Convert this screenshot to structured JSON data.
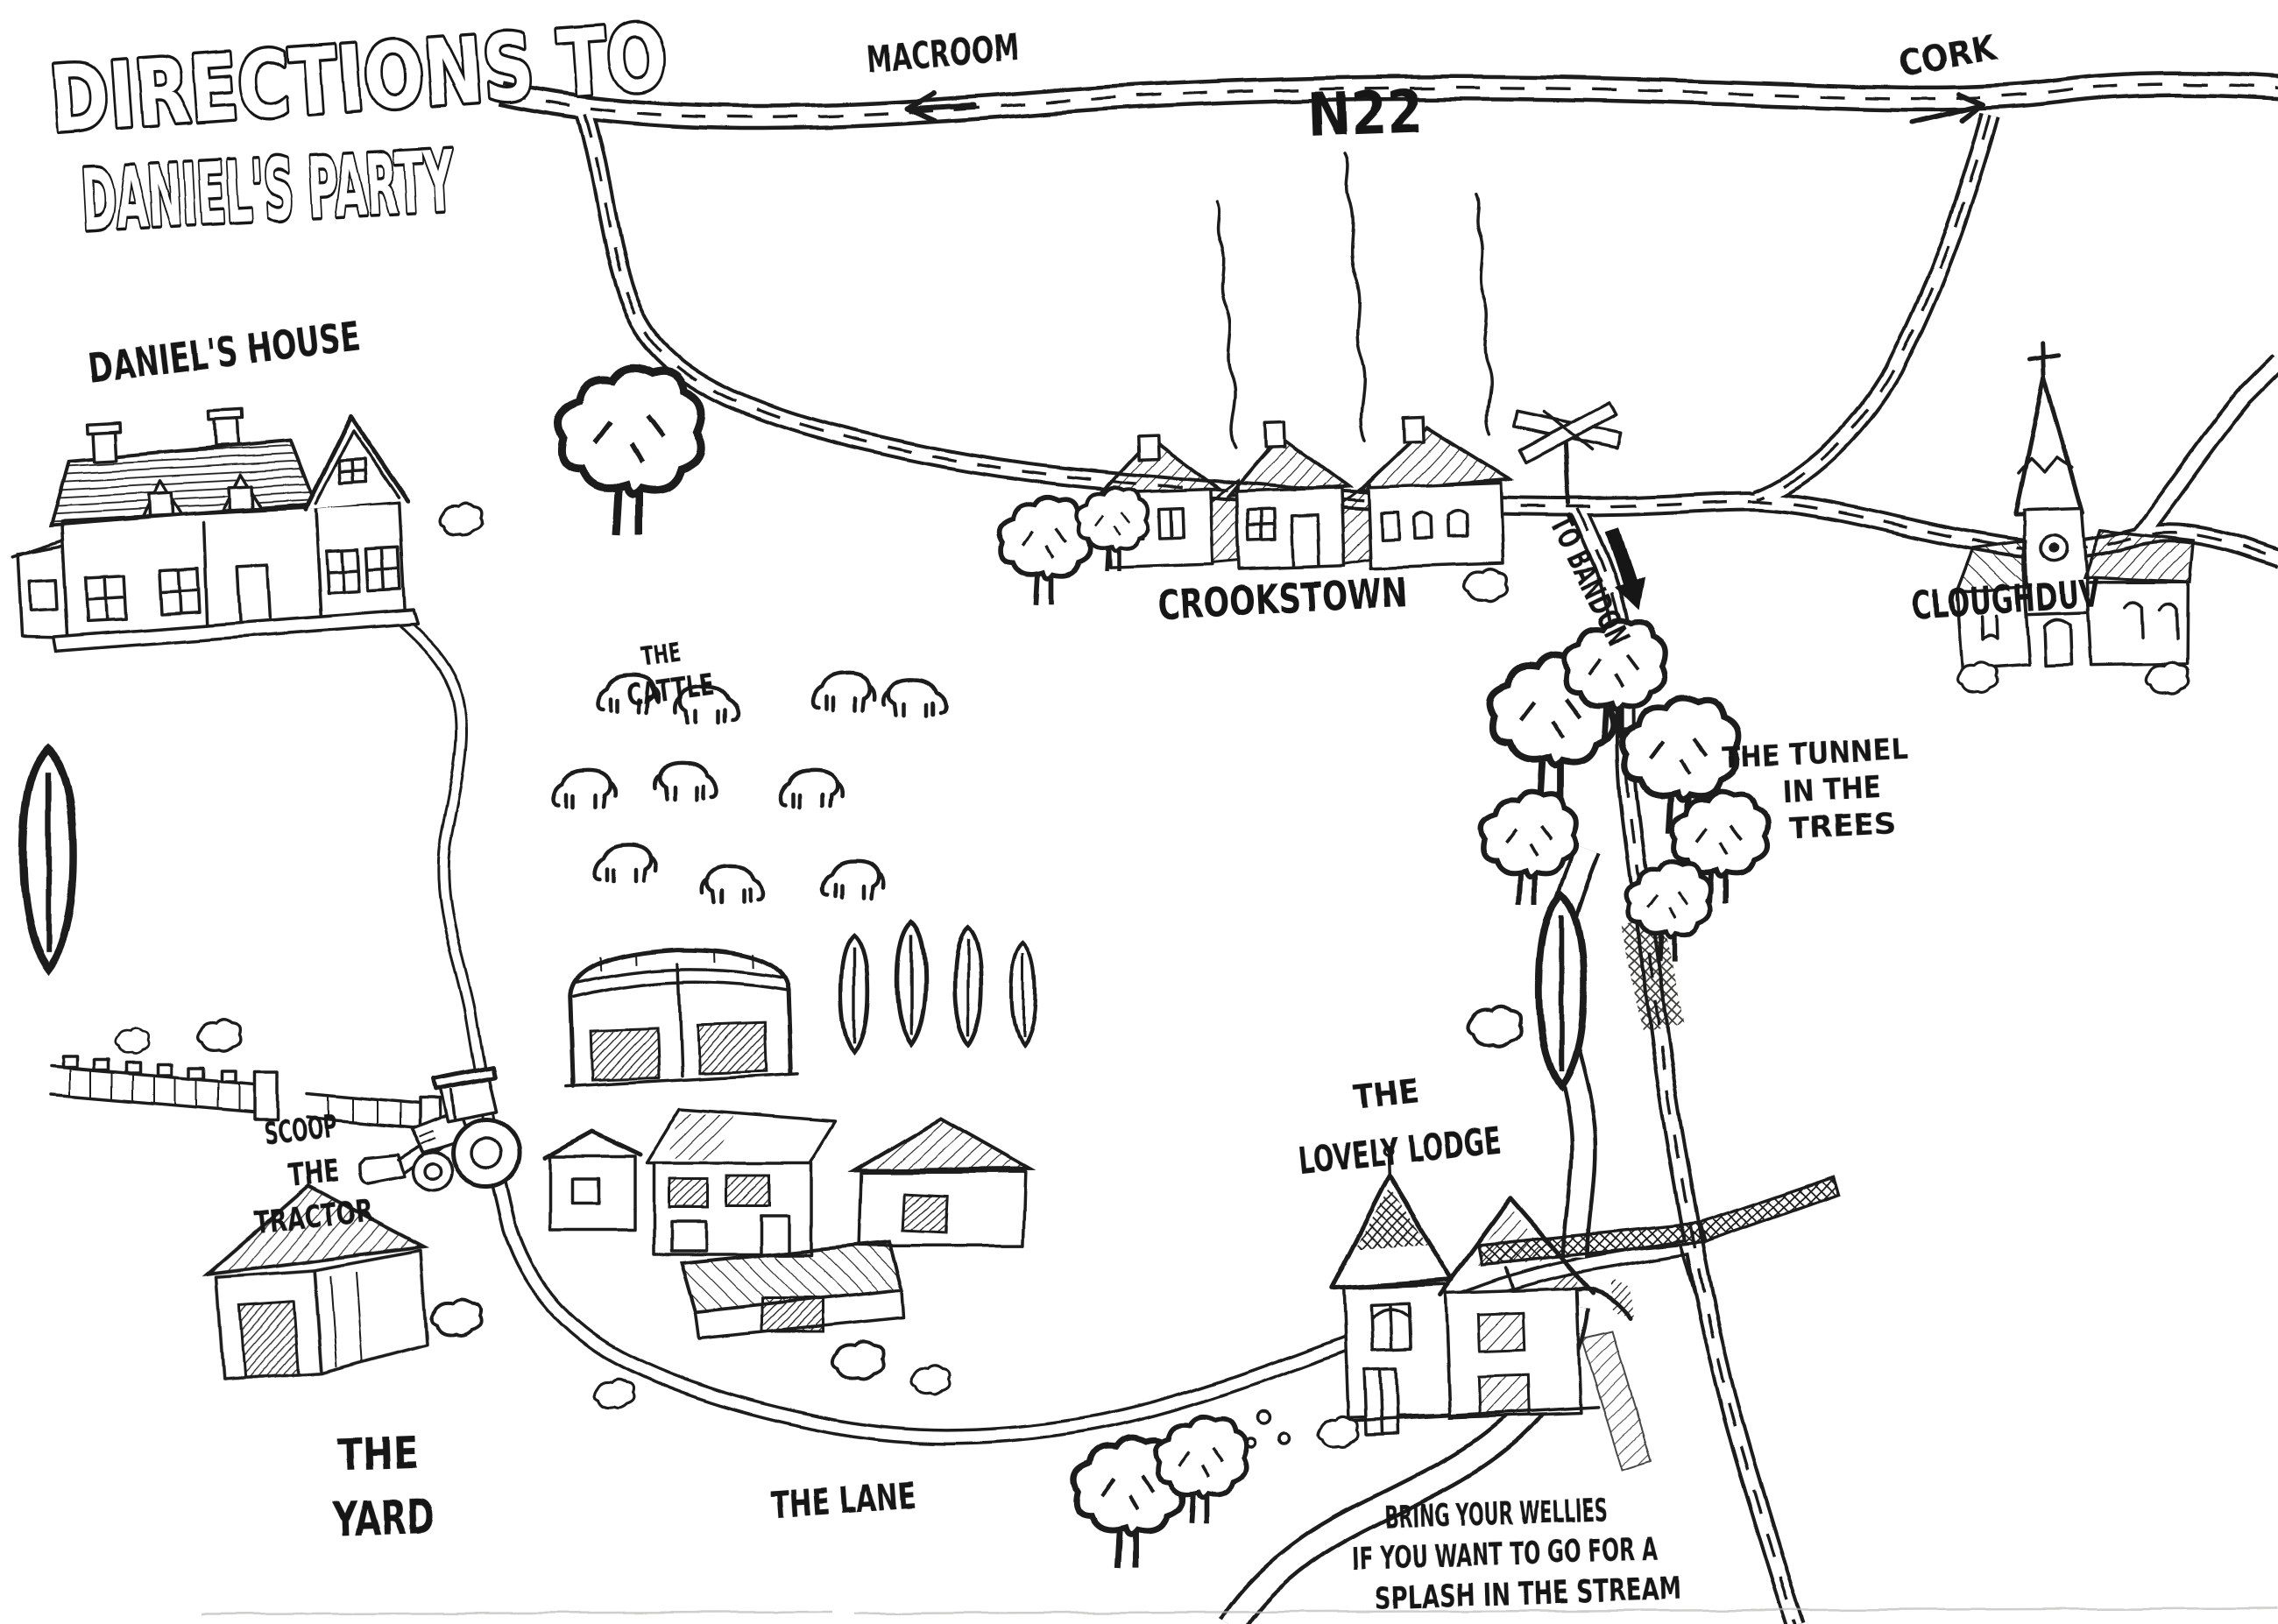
{
  "colors": {
    "ink": "#1d1d1b",
    "paper": "#ffffff"
  },
  "title": {
    "line1": "DIRECTIONS TO",
    "line2": "DANIEL'S PARTY"
  },
  "roads": {
    "n22": "N22",
    "macroom": "MACROOM",
    "cork": "CORK",
    "to_bandon": "TO BANDON"
  },
  "icons": {
    "macroom_arrow": "arrow-left-icon",
    "cork_arrow": "arrow-right-icon",
    "bandon_arrow": "arrow-down-icon",
    "signpost": "crossed-signpost-icon"
  },
  "places": {
    "daniels_house": "DANIEL'S HOUSE",
    "crookstown": "CROOKSTOWN",
    "cloughduv": "CLOUGHDUV",
    "cattle": {
      "lines": [
        "THE",
        "CATTLE"
      ]
    },
    "tunnel": {
      "lines": [
        "THE TUNNEL",
        "IN THE",
        "TREES"
      ]
    },
    "tractor": {
      "lines": [
        "SCOOP",
        "THE",
        "TRACTOR"
      ]
    },
    "lodge": {
      "lines": [
        "THE",
        "LOVELY LODGE"
      ]
    },
    "yard": {
      "lines": [
        "THE",
        "YARD"
      ]
    },
    "lane": "THE LANE"
  },
  "note": {
    "lines": [
      "BRING YOUR WELLIES",
      "IF YOU WANT TO GO FOR A",
      "SPLASH IN THE STREAM"
    ]
  }
}
